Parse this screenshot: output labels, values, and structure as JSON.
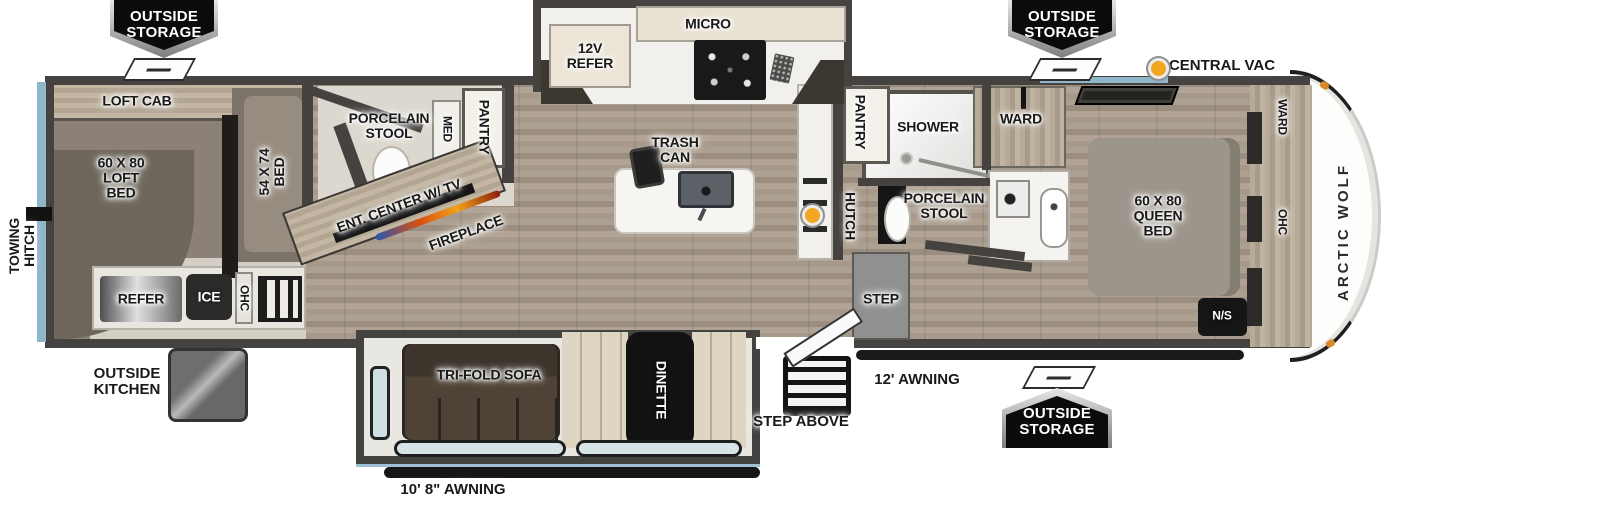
{
  "title": "Arctic Wolf Fifth Wheel Floorplan",
  "colors": {
    "wall": "#45423f",
    "accent_blue": "#8fb7c9",
    "vac_orange": "#f2a51f",
    "badge_bg": "#0b0b0b",
    "label_text": "#191919",
    "floor_wood": "#a89a8b",
    "loft_carpet": "#8b8177",
    "slide_interior": "#e9e7e2"
  },
  "badges": {
    "top_left": "OUTSIDE\nSTORAGE",
    "top_right": "OUTSIDE\nSTORAGE",
    "bottom_right": "OUTSIDE\nSTORAGE"
  },
  "legend": {
    "central_vac": "CENTRAL VAC"
  },
  "exterior": {
    "towing_hitch": "TOWING\nHITCH",
    "outside_kitchen": "OUTSIDE\nKITCHEN",
    "step_above": "STEP ABOVE",
    "awning_right": "12' AWNING",
    "awning_left": "10' 8\" AWNING",
    "brand": "ARCTIC WOLF"
  },
  "front_room": {
    "loft_cab": "LOFT CAB",
    "loft_bed": "60 X 80\nLOFT\nBED",
    "bed_54x74": "54 X 74\nBED",
    "refer": "REFER",
    "ice": "ICE",
    "ohc": "OHC"
  },
  "bath_left": {
    "porcelain_stool": "PORCELAIN\nSTOOL",
    "med": "MED",
    "pantry": "PANTRY"
  },
  "living": {
    "ent_center": "ENT. CENTER W/ TV",
    "fireplace": "FIREPLACE",
    "trifold_sofa": "TRI-FOLD SOFA",
    "dinette": "DINETTE"
  },
  "kitchen": {
    "refer_12v": "12V\nREFER",
    "micro": "MICRO",
    "trash_can": "TRASH\nCAN"
  },
  "mid": {
    "pantry": "PANTRY",
    "shower": "SHOWER",
    "hutch": "HUTCH",
    "porcelain_stool": "PORCELAIN\nSTOOL",
    "step": "STEP",
    "ward": "WARD"
  },
  "bedroom": {
    "queen_bed": "60 X 80\nQUEEN\nBED",
    "ns": "N/S",
    "ward": "WARD",
    "ohc": "OHC"
  }
}
